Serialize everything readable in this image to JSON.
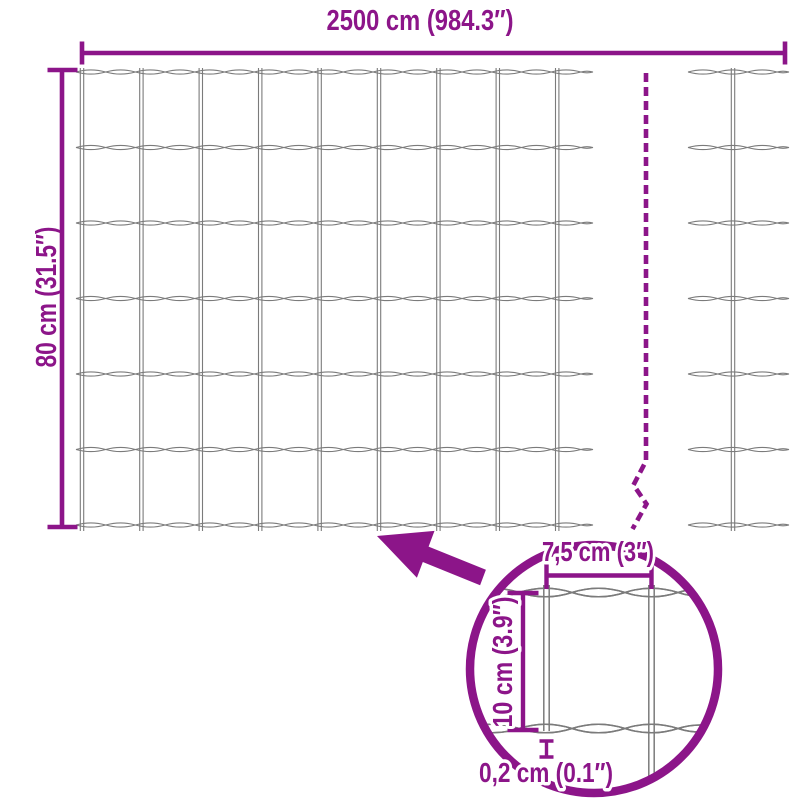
{
  "diagram": {
    "dimensions": {
      "total_width": "2500 cm (984.3″)",
      "total_height": "80 cm (31.5″)"
    },
    "detail": {
      "mesh_opening_width": "7,5 cm (3″)",
      "mesh_opening_height": "10 cm (3.9″)",
      "wire_thickness": "0,2 cm (0.1″)"
    },
    "colors": {
      "accent": "#8C1589",
      "wire": "#7B7B7B",
      "background": "#FFFFFF"
    }
  }
}
